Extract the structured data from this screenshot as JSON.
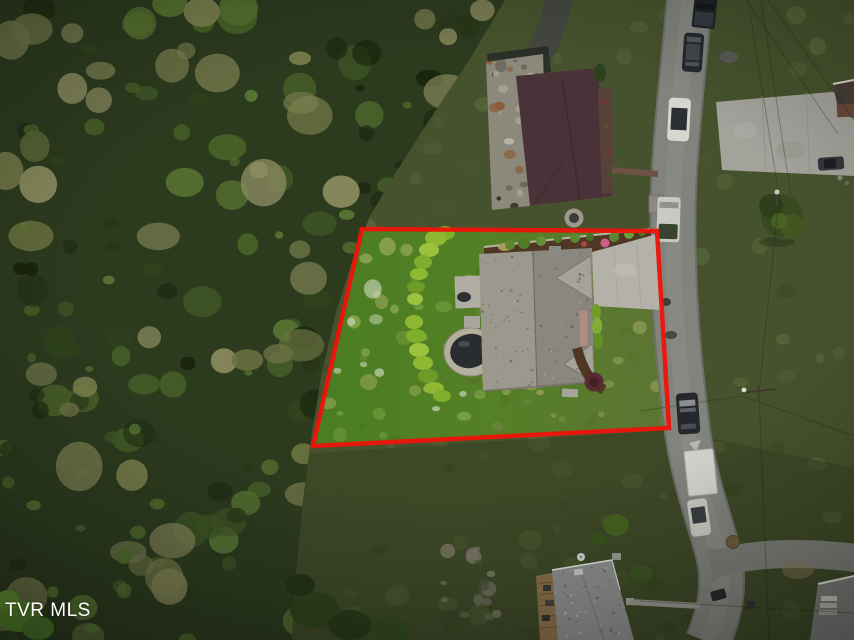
{
  "watermark": {
    "text": "TVR MLS",
    "color": "#ffffff"
  },
  "property_boundary": {
    "color": "#ee1309",
    "stroke_width": "4.5",
    "points": "362,229 657,231 669,428 313,446"
  },
  "colors": {
    "grass_base": "#46522d",
    "forest_base": "#2c3a1e",
    "lawn_left": "#4a7d22",
    "lawn_right": "#5d7434",
    "road": "#83837e",
    "road_shoulder": "#70706b",
    "road_branch": "#7d7d78",
    "subject_driveway_concrete": "#b3b1a8",
    "neighbor_concrete": "#a3a29b",
    "subject_roof_left": "#9b988e",
    "subject_roof_right": "#8a877e",
    "roof_hip_facet": "#a5a299",
    "neighbor_top_roof": "#493338",
    "bottom_house_roof": "#8e8f8e",
    "hedge_green": "#8fb832",
    "mulch_brown": "#4e3723",
    "burgundy_shrub": "#582a31",
    "hot_tub_water": "#2a2d2f",
    "hot_tub_ring": "#b5af9f",
    "deck_wood": "#8a6f4a",
    "asphalt_driveway": "#43473f"
  },
  "scene": {
    "kind": "aerial-drone-photo-of-residential-lot",
    "outlined_lot": {
      "outline": "red quadrilateral",
      "contents": [
        "gray-shingle-roof-house",
        "bright-lawn",
        "curved-hedge-row",
        "hot-tub",
        "concrete-driveway",
        "mulch-bed-with-shrubs",
        "pink-flowering-shrub",
        "burgundy-shrub"
      ]
    },
    "surroundings": [
      "dense-forest-left",
      "street-right",
      "neighbor-house-top",
      "neighbor-house-bottom",
      "power-lines",
      "street-tree"
    ],
    "vehicles": [
      {
        "name": "dark-pickup-truck"
      },
      {
        "name": "dark-car"
      },
      {
        "name": "white-sedan"
      },
      {
        "name": "white-van-dark-top"
      },
      {
        "name": "dark-suv"
      },
      {
        "name": "white-box-trailer"
      },
      {
        "name": "white-car"
      },
      {
        "name": "dark-car-on-concrete-pad"
      }
    ]
  }
}
